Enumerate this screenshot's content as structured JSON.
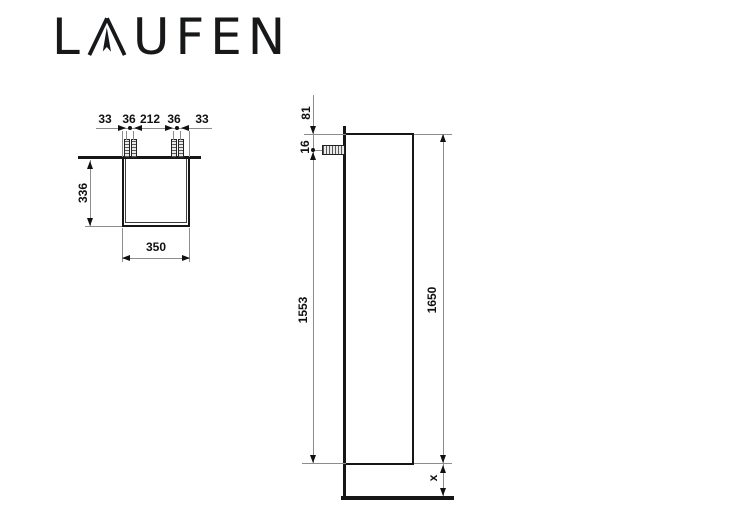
{
  "logo": {
    "brand": "LAUFEN",
    "letters_before": "L",
    "letters_after": "UFEN"
  },
  "colors": {
    "ink": "#111111",
    "object_line": "#161616",
    "hairline": "#8d8d8d",
    "paper": "#ffffff"
  },
  "top_view": {
    "chain_labels": [
      "33",
      "36",
      "212",
      "36",
      "33"
    ],
    "depth_label": "336",
    "width_label": "350"
  },
  "side_view": {
    "top_offset_label": "81",
    "screw_offset_label": "16",
    "screw_to_bottom_label": "1553",
    "height_label": "1650",
    "bottom_clearance_label": "x"
  }
}
